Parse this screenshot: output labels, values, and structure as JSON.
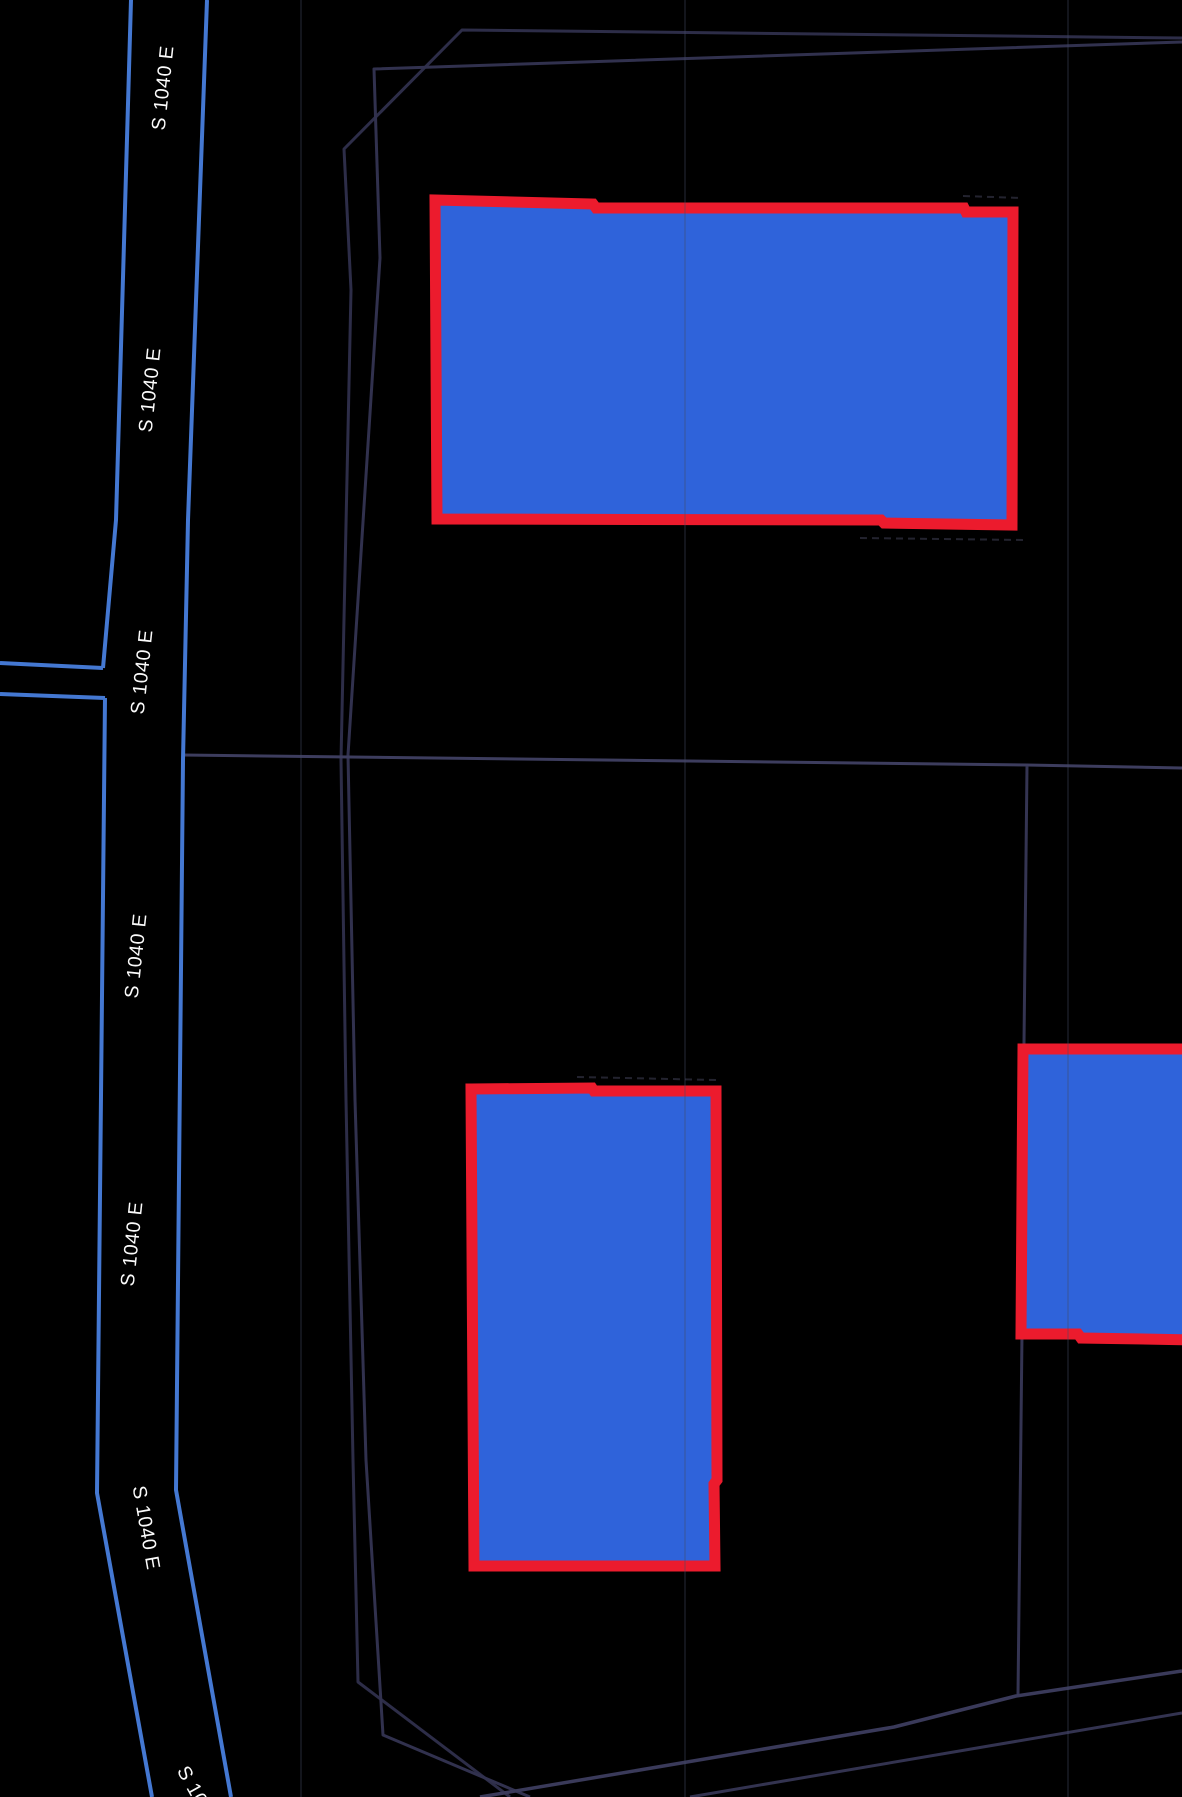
{
  "map": {
    "type": "dark-basemap-parcel-view",
    "background_color": "#000000",
    "street": {
      "name": "S 1040 E",
      "edge_line_color": "#4478d2"
    },
    "street_labels": [
      {
        "text": "S 1040 E",
        "clipped": false
      },
      {
        "text": "S 1040 E",
        "clipped": false
      },
      {
        "text": "S 1040 E",
        "clipped": false
      },
      {
        "text": "S 1040 E",
        "clipped": false
      },
      {
        "text": "S 1040 E",
        "clipped": false
      },
      {
        "text": "S 1040 E",
        "clipped": false
      },
      {
        "text": "S 1040 E",
        "clipped": true
      }
    ],
    "parcel_boundaries": {
      "line_color": "#353552",
      "count_visible": 6
    },
    "highlighted_features": {
      "fill_color": "#2f63da",
      "outline_color": "#ec1b2d",
      "items": [
        {
          "name": "highlight-parcel-top"
        },
        {
          "name": "highlight-parcel-middle"
        },
        {
          "name": "highlight-parcel-right"
        }
      ]
    }
  }
}
